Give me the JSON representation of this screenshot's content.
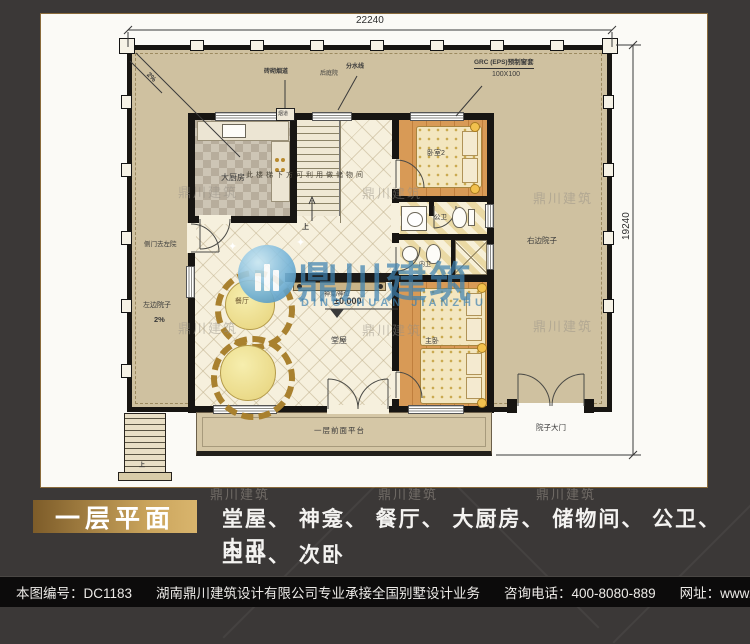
{
  "dims": {
    "width": "22240",
    "height": "19240"
  },
  "plan": {
    "rooms": {
      "kitchen": "大厨房",
      "dining": "餐厅",
      "hall": "堂屋",
      "bedroom2": "卧室2",
      "public_bath": "公卫",
      "private_bath": "内卫",
      "master": "主卧"
    },
    "labels": {
      "slope_corner": "2%",
      "chimney": "砖砌烟道",
      "flue": "烟道",
      "back_yard": "后庭院",
      "water_line": "分水线",
      "grc": "GRC (EPS)预制窗套",
      "grc_size": "100X100",
      "storage_note": "此楼梯下方可利用做储物间",
      "stairs_up": "上",
      "altar": "神龛/神位",
      "level": "±0.000",
      "side_door": "侧门去左院",
      "left_yard": "左边院子",
      "left_yard_slope": "2%",
      "right_yard": "右边院子",
      "yard_gate": "院子大门",
      "platform": "一层前面平台"
    }
  },
  "watermark": {
    "cn": "鼎川建筑",
    "en": "DINGCHUAN JIANZHU"
  },
  "icons": {
    "sparkle": "✦"
  },
  "caption": {
    "title": "一层平面",
    "line1": "堂屋、 神龛、 餐厅、 大厨房、 储物间、 公卫、 内卫",
    "line2": "主卧、 次卧"
  },
  "footer": {
    "sheet_no": "本图编号：DC1183",
    "company": "湖南鼎川建筑设计有限公司专业承接全国别墅设计业务",
    "phone": "咨询电话：400-8080-889",
    "website": "网址：www.bstzcs.com"
  },
  "colors": {
    "background_dark": "#3b3837",
    "sheet_white": "#fbfaf6",
    "courtyard_tan": "#cfc1a0",
    "wall_black": "#171512",
    "wood_floor": "#d89a56",
    "accent_gold": "#caa45c",
    "watermark_blue": "#3e82b0",
    "footer_black": "#0c0b0b"
  }
}
